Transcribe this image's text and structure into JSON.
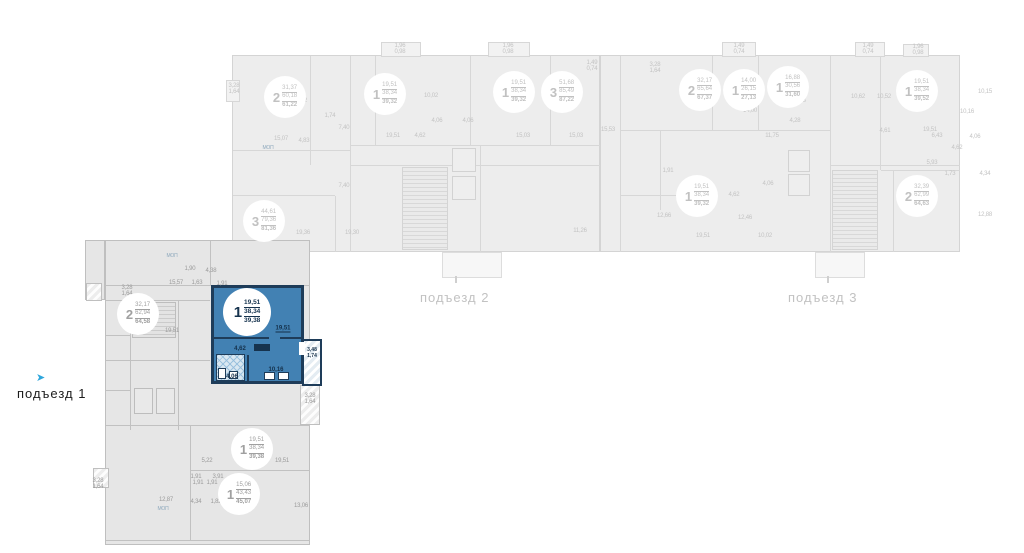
{
  "colors": {
    "highlight_fill": "#4281b3",
    "highlight_wall": "#1e3c59",
    "entrance_arrow": "#2ea6dc",
    "faded_text": "#c3c3c3",
    "active_text": "#9b9b9b"
  },
  "icons": {
    "entrance_arrow": "➤"
  },
  "sections": [
    {
      "id": "podezd-1",
      "label": "подъезд 1",
      "active": true
    },
    {
      "id": "podezd-2",
      "label": "подъезд 2",
      "active": false
    },
    {
      "id": "podezd-3",
      "label": "подъезд 3",
      "active": false
    }
  ],
  "highlighted_unit": {
    "rooms": "1",
    "area_living": "19,51",
    "area_base": "38,34",
    "area_total": "39,38",
    "room_labels": {
      "living": "19,51",
      "hall": "4,62",
      "bath": "4,06",
      "kitchen": "10,16",
      "balcony_full": "3,48",
      "balcony_reduced": "1,74"
    }
  },
  "units": [
    {
      "section": "podezd-2",
      "x": 285,
      "y": 97,
      "rooms": "2",
      "a1": "31,37",
      "a2": "60,18",
      "a3": "61,22",
      "cls": "f"
    },
    {
      "section": "podezd-2",
      "x": 385,
      "y": 94,
      "rooms": "1",
      "a1": "19,51",
      "a2": "38,34",
      "a3": "39,32",
      "cls": "f"
    },
    {
      "section": "podezd-2",
      "x": 514,
      "y": 92,
      "rooms": "1",
      "a1": "19,51",
      "a2": "38,34",
      "a3": "39,32",
      "cls": "f"
    },
    {
      "section": "podezd-2",
      "x": 562,
      "y": 92,
      "rooms": "3",
      "a1": "51,68",
      "a2": "85,49",
      "a3": "87,22",
      "cls": "f"
    },
    {
      "section": "podezd-2",
      "x": 264,
      "y": 221,
      "rooms": "3",
      "a1": "44,61",
      "a2": "79,36",
      "a3": "81,36",
      "cls": "f"
    },
    {
      "section": "podezd-3",
      "x": 700,
      "y": 90,
      "rooms": "2",
      "a1": "32,17",
      "a2": "65,64",
      "a3": "67,37",
      "cls": "f"
    },
    {
      "section": "podezd-3",
      "x": 744,
      "y": 90,
      "rooms": "1",
      "a1": "14,00",
      "a2": "26,15",
      "a3": "27,13",
      "cls": "f"
    },
    {
      "section": "podezd-3",
      "x": 788,
      "y": 87,
      "rooms": "1",
      "a1": "16,88",
      "a2": "30,56",
      "a3": "31,60",
      "cls": "f"
    },
    {
      "section": "podezd-3",
      "x": 917,
      "y": 91,
      "rooms": "1",
      "a1": "19,51",
      "a2": "38,34",
      "a3": "39,52",
      "cls": "f"
    },
    {
      "section": "podezd-3",
      "x": 697,
      "y": 196,
      "rooms": "1",
      "a1": "19,51",
      "a2": "38,34",
      "a3": "39,32",
      "cls": "f"
    },
    {
      "section": "podezd-3",
      "x": 917,
      "y": 196,
      "rooms": "2",
      "a1": "32,39",
      "a2": "62,99",
      "a3": "64,63",
      "cls": "f"
    },
    {
      "section": "podezd-1",
      "x": 138,
      "y": 314,
      "rooms": "2",
      "a1": "32,17",
      "a2": "62,94",
      "a3": "64,58",
      "cls": "a"
    },
    {
      "section": "podezd-1",
      "x": 247,
      "y": 312,
      "rooms": "1",
      "a1": "19,51",
      "a2": "38,34",
      "a3": "39,38",
      "cls": "hl",
      "highlight": true
    },
    {
      "section": "podezd-1",
      "x": 252,
      "y": 449,
      "rooms": "1",
      "a1": "19,51",
      "a2": "38,34",
      "a3": "39,38",
      "cls": "a"
    },
    {
      "section": "podezd-1",
      "x": 239,
      "y": 494,
      "rooms": "1",
      "a1": "15,06",
      "a2": "43,43",
      "a3": "45,07",
      "cls": "a"
    }
  ],
  "minor_labels": [
    {
      "t": "3,28",
      "x": 234,
      "y": 86,
      "c": "f"
    },
    {
      "t": "1,64",
      "x": 234,
      "y": 92,
      "c": "f"
    },
    {
      "t": "1,96",
      "x": 400,
      "y": 46,
      "c": "f"
    },
    {
      "t": "0,98",
      "x": 400,
      "y": 52,
      "c": "f"
    },
    {
      "t": "1,96",
      "x": 508,
      "y": 46,
      "c": "f"
    },
    {
      "t": "0,98",
      "x": 508,
      "y": 52,
      "c": "f"
    },
    {
      "t": "1,49",
      "x": 592,
      "y": 63,
      "c": "f"
    },
    {
      "t": "0,74",
      "x": 592,
      "y": 69,
      "c": "f"
    },
    {
      "t": "19,22",
      "x": 300,
      "y": 101,
      "c": "f"
    },
    {
      "t": "1,74",
      "x": 330,
      "y": 116,
      "c": "f"
    },
    {
      "t": "15,07",
      "x": 281,
      "y": 139,
      "c": "f"
    },
    {
      "t": "4,83",
      "x": 304,
      "y": 141,
      "c": "f"
    },
    {
      "t": "7,40",
      "x": 344,
      "y": 128,
      "c": "f"
    },
    {
      "t": "7,40",
      "x": 344,
      "y": 186,
      "c": "f"
    },
    {
      "t": "10,02",
      "x": 431,
      "y": 96,
      "c": "f"
    },
    {
      "t": "4,06",
      "x": 437,
      "y": 121,
      "c": "f"
    },
    {
      "t": "4,06",
      "x": 468,
      "y": 121,
      "c": "f"
    },
    {
      "t": "19,51",
      "x": 393,
      "y": 136,
      "c": "f"
    },
    {
      "t": "4,62",
      "x": 420,
      "y": 136,
      "c": "f"
    },
    {
      "t": "15,03",
      "x": 523,
      "y": 136,
      "c": "f"
    },
    {
      "t": "15,03",
      "x": 576,
      "y": 136,
      "c": "f"
    },
    {
      "t": "19,36",
      "x": 303,
      "y": 233,
      "c": "f"
    },
    {
      "t": "19,30",
      "x": 352,
      "y": 233,
      "c": "f"
    },
    {
      "t": "11,26",
      "x": 580,
      "y": 231,
      "c": "f"
    },
    {
      "t": "МОП",
      "x": 268,
      "y": 148,
      "c": "m"
    },
    {
      "t": "3,28",
      "x": 655,
      "y": 65,
      "c": "f"
    },
    {
      "t": "1,64",
      "x": 655,
      "y": 71,
      "c": "f"
    },
    {
      "t": "1,49",
      "x": 739,
      "y": 46,
      "c": "f"
    },
    {
      "t": "0,74",
      "x": 739,
      "y": 52,
      "c": "f"
    },
    {
      "t": "1,49",
      "x": 868,
      "y": 46,
      "c": "f"
    },
    {
      "t": "0,74",
      "x": 868,
      "y": 52,
      "c": "f"
    },
    {
      "t": "1,96",
      "x": 918,
      "y": 47,
      "c": "f"
    },
    {
      "t": "0,98",
      "x": 918,
      "y": 53,
      "c": "f"
    },
    {
      "t": "15,53",
      "x": 608,
      "y": 130,
      "c": "f"
    },
    {
      "t": "14,00",
      "x": 750,
      "y": 111,
      "c": "f"
    },
    {
      "t": "11,75",
      "x": 772,
      "y": 136,
      "c": "f"
    },
    {
      "t": "11,73",
      "x": 799,
      "y": 101,
      "c": "f"
    },
    {
      "t": "4,28",
      "x": 795,
      "y": 121,
      "c": "f"
    },
    {
      "t": "10,62",
      "x": 858,
      "y": 97,
      "c": "f"
    },
    {
      "t": "10,15",
      "x": 985,
      "y": 92,
      "c": "f"
    },
    {
      "t": "10,52",
      "x": 884,
      "y": 97,
      "c": "f"
    },
    {
      "t": "4,61",
      "x": 885,
      "y": 131,
      "c": "f"
    },
    {
      "t": "19,51",
      "x": 930,
      "y": 130,
      "c": "f"
    },
    {
      "t": "10,16",
      "x": 967,
      "y": 112,
      "c": "f"
    },
    {
      "t": "6,43",
      "x": 937,
      "y": 136,
      "c": "f"
    },
    {
      "t": "4,06",
      "x": 975,
      "y": 137,
      "c": "f"
    },
    {
      "t": "4,62",
      "x": 957,
      "y": 148,
      "c": "f"
    },
    {
      "t": "5,93",
      "x": 932,
      "y": 163,
      "c": "f"
    },
    {
      "t": "1,73",
      "x": 950,
      "y": 174,
      "c": "f"
    },
    {
      "t": "4,34",
      "x": 985,
      "y": 174,
      "c": "f"
    },
    {
      "t": "12,88",
      "x": 985,
      "y": 215,
      "c": "f"
    },
    {
      "t": "1,91",
      "x": 668,
      "y": 171,
      "c": "f"
    },
    {
      "t": "12,66",
      "x": 664,
      "y": 216,
      "c": "f"
    },
    {
      "t": "19,51",
      "x": 703,
      "y": 236,
      "c": "f"
    },
    {
      "t": "10,02",
      "x": 765,
      "y": 236,
      "c": "f"
    },
    {
      "t": "4,62",
      "x": 734,
      "y": 195,
      "c": "f"
    },
    {
      "t": "4,06",
      "x": 768,
      "y": 184,
      "c": "f"
    },
    {
      "t": "12,46",
      "x": 745,
      "y": 218,
      "c": "f"
    },
    {
      "t": "3,28",
      "x": 127,
      "y": 288,
      "c": "a"
    },
    {
      "t": "1,64",
      "x": 127,
      "y": 294,
      "c": "a"
    },
    {
      "t": "15,57",
      "x": 176,
      "y": 283,
      "c": "a"
    },
    {
      "t": "1,63",
      "x": 197,
      "y": 283,
      "c": "a"
    },
    {
      "t": "1,90",
      "x": 190,
      "y": 269,
      "c": "a"
    },
    {
      "t": "4,38",
      "x": 211,
      "y": 271,
      "c": "a"
    },
    {
      "t": "1,91",
      "x": 222,
      "y": 284,
      "c": "a"
    },
    {
      "t": "19,51",
      "x": 172,
      "y": 331,
      "c": "a"
    },
    {
      "t": "МОП",
      "x": 172,
      "y": 256,
      "c": "m"
    },
    {
      "t": "3,28",
      "x": 310,
      "y": 396,
      "c": "a"
    },
    {
      "t": "1,64",
      "x": 310,
      "y": 402,
      "c": "a"
    },
    {
      "t": "5,22",
      "x": 207,
      "y": 461,
      "c": "a"
    },
    {
      "t": "19,51",
      "x": 282,
      "y": 461,
      "c": "a"
    },
    {
      "t": "1,91",
      "x": 196,
      "y": 477,
      "c": "a"
    },
    {
      "t": "3,91",
      "x": 218,
      "y": 477,
      "c": "a"
    },
    {
      "t": "13,06",
      "x": 301,
      "y": 506,
      "c": "a"
    },
    {
      "t": "3,28",
      "x": 98,
      "y": 481,
      "c": "a"
    },
    {
      "t": "1,64",
      "x": 98,
      "y": 487,
      "c": "a"
    },
    {
      "t": "1,91",
      "x": 198,
      "y": 483,
      "c": "a"
    },
    {
      "t": "1,91",
      "x": 212,
      "y": 483,
      "c": "a"
    },
    {
      "t": "12,87",
      "x": 166,
      "y": 500,
      "c": "a"
    },
    {
      "t": "4,34",
      "x": 196,
      "y": 502,
      "c": "a"
    },
    {
      "t": "1,82",
      "x": 216,
      "y": 502,
      "c": "a"
    },
    {
      "t": "МОП",
      "x": 163,
      "y": 509,
      "c": "m"
    }
  ]
}
